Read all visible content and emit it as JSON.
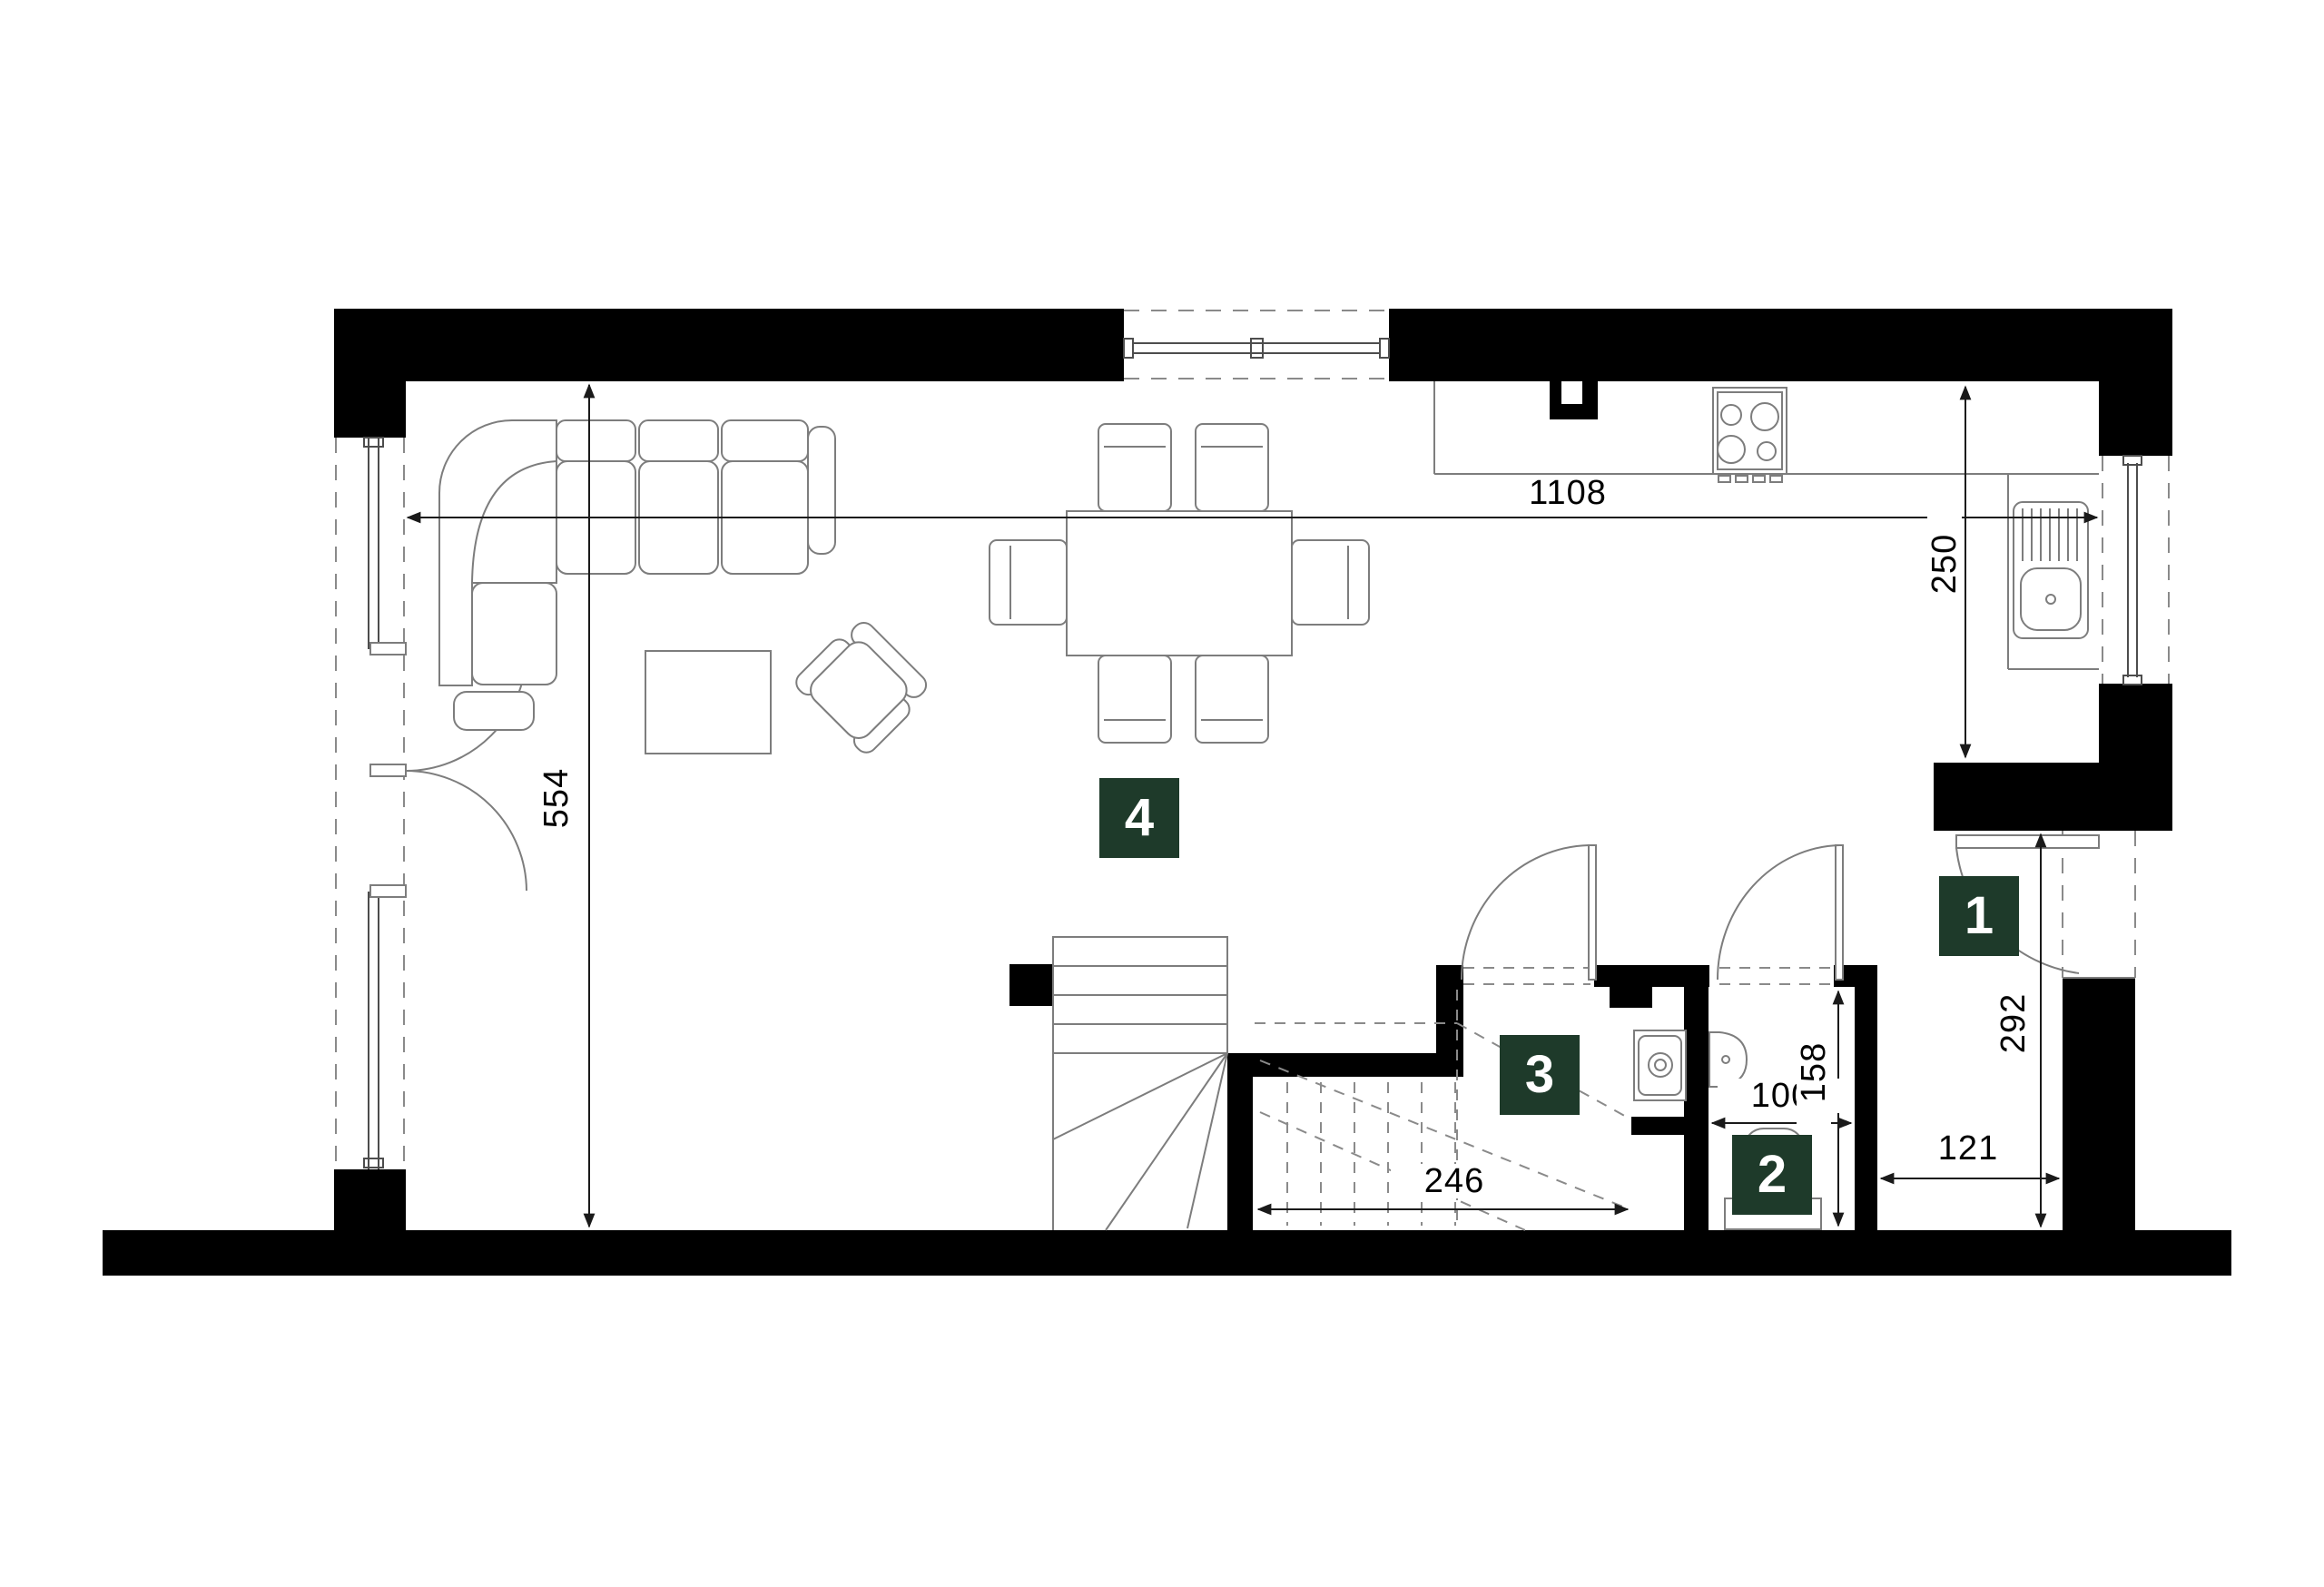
{
  "plan_title": "floor-plan-level",
  "colors": {
    "wall": "#000000",
    "badge_green": "#1e3a2a",
    "furniture_line": "#7d7d7d",
    "dimension_line": "#1a1a1a",
    "background": "#ffffff"
  },
  "rooms": [
    {
      "number": "1"
    },
    {
      "number": "2"
    },
    {
      "number": "3"
    },
    {
      "number": "4"
    }
  ],
  "dimensions": {
    "living_width": {
      "value": "1108"
    },
    "kitchen_depth": {
      "value": "250"
    },
    "living_depth": {
      "value": "554"
    },
    "stair_width": {
      "value": "246"
    },
    "wc_width": {
      "value": "100"
    },
    "wc_depth": {
      "value": "158"
    },
    "hall_depth": {
      "value": "292"
    },
    "hall_width": {
      "value": "121"
    }
  }
}
